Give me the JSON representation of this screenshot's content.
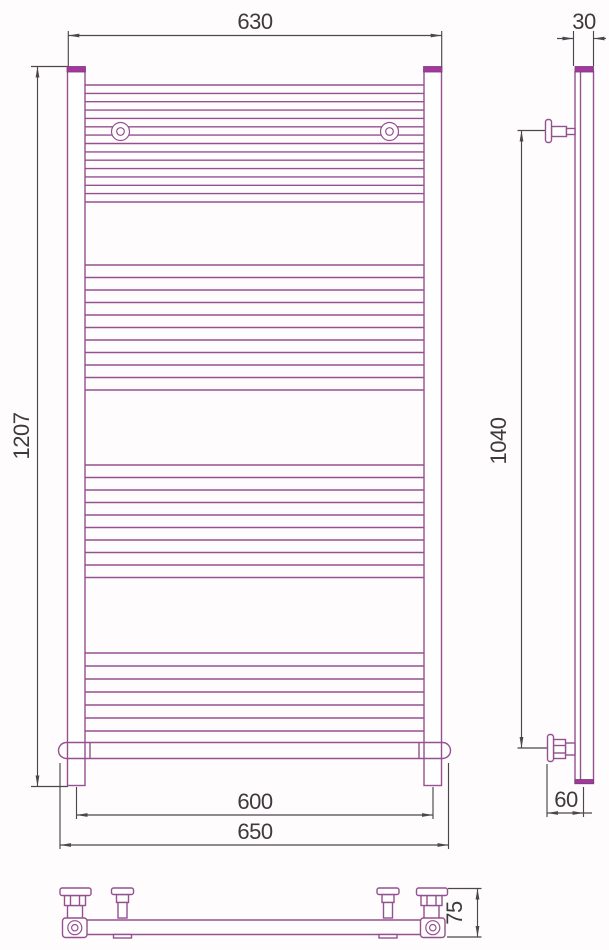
{
  "drawing": {
    "type": "towel-radiator-technical-drawing",
    "views": {
      "front": "front-view",
      "side": "side-view",
      "bottom": "bottom-view"
    },
    "dims": {
      "front_top_width": "630",
      "tube_diameter": "30",
      "front_height": "1207",
      "mount_height": "1040",
      "axis_width": "600",
      "overall_width": "650",
      "wall_offset": "60",
      "depth": "75"
    },
    "colors": {
      "outline": "#95508f",
      "cap_fill": "#a337a0",
      "dimension": "#4b474b",
      "text": "#3d393d",
      "background": "#fefcfd"
    }
  }
}
